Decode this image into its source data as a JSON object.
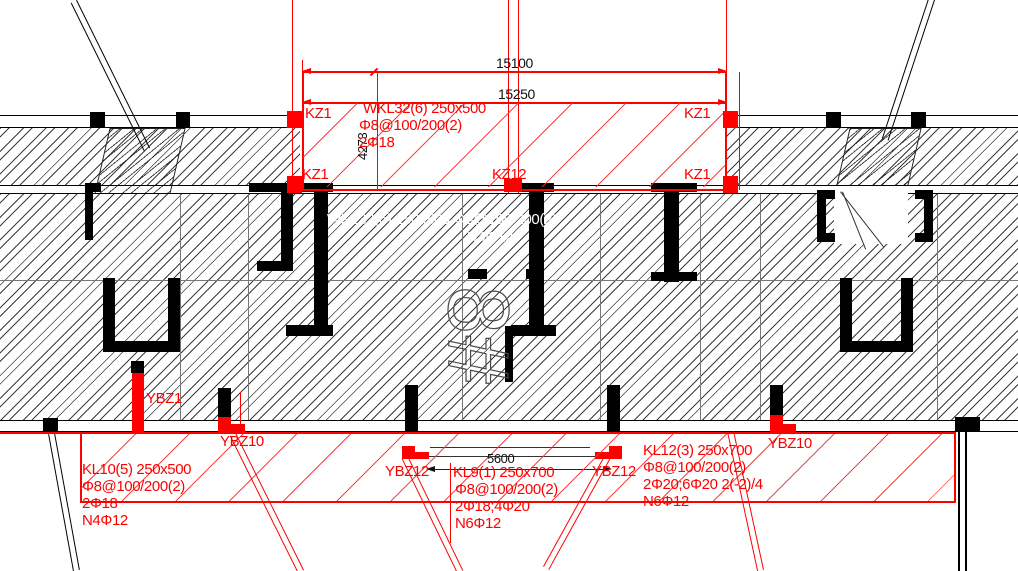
{
  "drawing": {
    "unit_label": "8#",
    "dimensions": {
      "top_outer": "15100",
      "top_inner": "15250",
      "left_vertical": "4273",
      "bottom_span": "5600"
    },
    "columns": {
      "kz1_top_left": "KZ1",
      "kz1_top_right": "KZ1",
      "kz1_bottom_left": "KZ1",
      "kz12_center": "KZ12",
      "kz1_bottom_right": "KZ1"
    },
    "edge_members": {
      "ybz1": "YBZ1",
      "ybz10_left": "YBZ10",
      "ybz12_left": "YBZ12",
      "ybz12_right": "YBZ12",
      "ybz10_right": "YBZ10"
    },
    "beams": {
      "wkl32": {
        "lines": [
          "WKL32(6) 250x500",
          "Φ8@100/200(2)",
          "2Φ18"
        ]
      },
      "kl10": {
        "lines": [
          "KL10(5) 250x500",
          "Φ8@100/200(2)",
          "2Φ18",
          "N4Φ12"
        ]
      },
      "kl9": {
        "lines": [
          "KL9(1) 250x700",
          "Φ8@100/200(2)",
          "2Φ18;4Φ20",
          "N6Φ12"
        ]
      },
      "kl12": {
        "lines": [
          "KL12(3) 250x700",
          "Φ8@100/200(2)",
          "2Φ20;6Φ20 2(-2)/4",
          "N6Φ12"
        ]
      }
    },
    "overlay_white_text": {
      "line1": "WKL32(6) 250x500 Φ8@100/200(2)",
      "line2": "N4Φ12"
    },
    "colors": {
      "annotation_red": "#ff0000",
      "line_black": "#000000",
      "overlay_white": "#ffffff"
    }
  }
}
